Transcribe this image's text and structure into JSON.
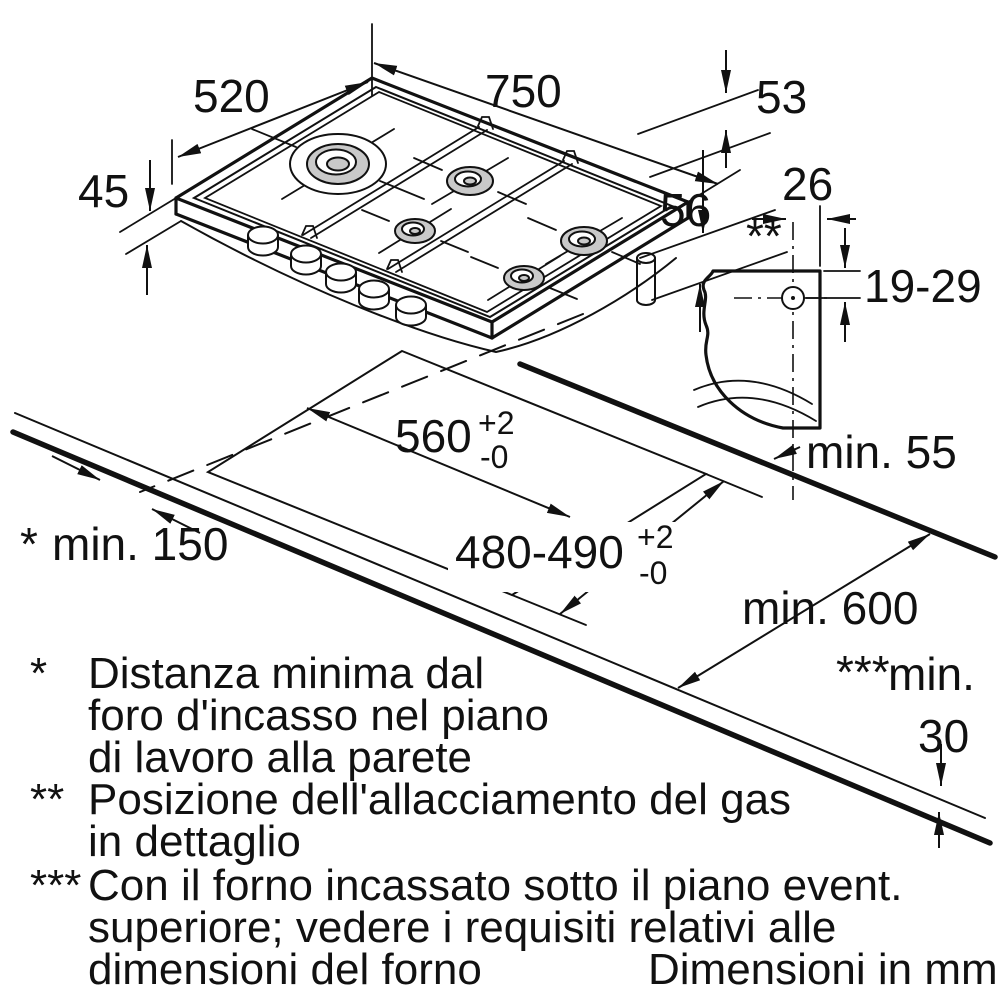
{
  "title": "Gas hob installation drawing",
  "colors": {
    "line": "#111111",
    "burner_fill": "#c9c9c9",
    "background": "#ffffff"
  },
  "dimensions": {
    "width": "750",
    "depth": "520",
    "height_left": "45",
    "rear_clearance_top": "53",
    "below_worktop": "56",
    "gas_offset": "26",
    "gas_height_range": "19-29",
    "gas_detail_marker": "**",
    "cutout_width": "560",
    "cutout_width_tol_plus": "+2",
    "cutout_width_tol_minus": "-0",
    "cutout_depth": "480-490",
    "cutout_depth_tol_plus": "+2",
    "cutout_depth_tol_minus": "-0",
    "min_rear": "min. 55",
    "min_side_marker": "*",
    "min_side": "min. 150",
    "min_worktop_depth": "min. 600",
    "min_below_marker": "***",
    "min_below_label": "min.",
    "min_below_value": "30"
  },
  "footnotes": [
    {
      "marker": "*",
      "lines": [
        "Distanza minima dal",
        "foro d'incasso nel piano",
        "di lavoro alla parete"
      ]
    },
    {
      "marker": "**",
      "lines": [
        "Posizione dell'allacciamento del gas",
        "in dettaglio"
      ]
    },
    {
      "marker": "***",
      "lines": [
        "Con il forno incassato sotto il piano event.",
        "superiore; vedere i requisiti relativi alle",
        "dimensioni del forno"
      ]
    }
  ],
  "footer_note": "Dimensioni in mm"
}
